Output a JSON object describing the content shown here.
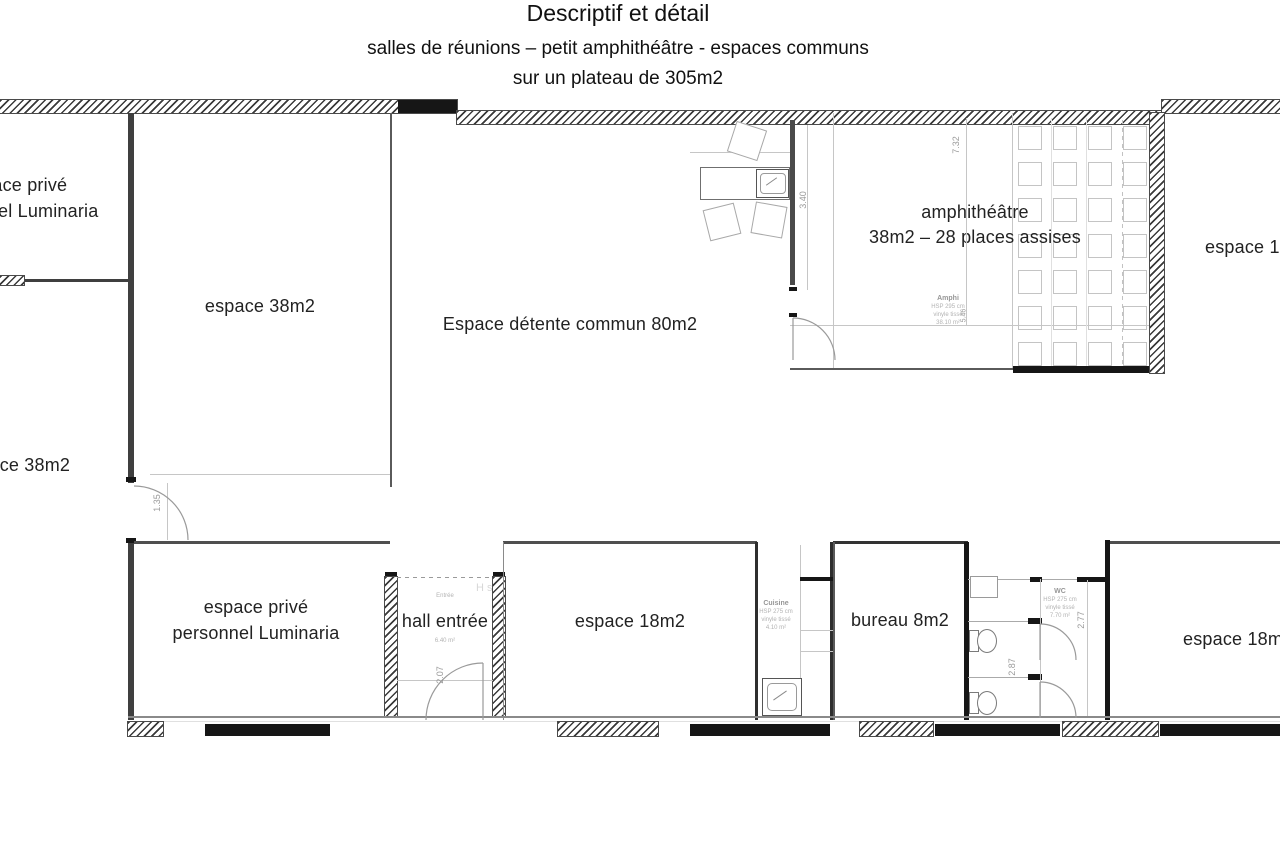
{
  "title": {
    "line1": "Descriptif et détail",
    "line2": "salles de réunions – petit amphithéâtre - espaces communs",
    "line3": "sur un plateau de 305m2"
  },
  "labels": {
    "top_left_1": "espace privé",
    "top_left_2": "personnel Luminaria",
    "espace38_top": "espace 38m2",
    "espace38_left": "espace 38m2",
    "detente": "Espace détente commun 80m2",
    "amphi_1": "amphithéâtre",
    "amphi_2": "38m2 – 28 places assises",
    "espace18_top_right": "espace 18m2",
    "private_bottom_1": "espace privé",
    "private_bottom_2": "personnel Luminaria",
    "hall": "hall entrée",
    "espace18_center": "espace 18m2",
    "bureau": "bureau 8m2",
    "espace18_bottom_right": "espace 18m2"
  },
  "annotations": {
    "amphi": {
      "name": "Amphi",
      "hsp": "HSP 295 cm",
      "finish": "vinyle tissé",
      "area": "38.10 m²"
    },
    "cuisine": {
      "name": "Cuisine",
      "hsp": "HSP 275 cm",
      "finish": "vinyle tissé",
      "area": "4.10 m²"
    },
    "wc": {
      "name": "WC",
      "hsp": "HSP 275 cm",
      "finish": "vinyle tissé",
      "area": "7.70 m²"
    },
    "hall_sub": "Entrée",
    "hall_area": "6.40 m²",
    "hall_tag": "H s"
  },
  "dimensions": {
    "d732": "7.32",
    "d340": "3.40",
    "d546": "5.46",
    "d207": "2.07",
    "d135": "1.35",
    "d277": "2.77",
    "d287": "2.87"
  },
  "amphi_seats": {
    "rows": 7,
    "cols": 4
  },
  "colors": {
    "wall_dark": "#161616",
    "wall_mid": "#3f3f3f",
    "hatch": "#3a3a3a",
    "muted_text": "#9a9a9a",
    "seat_line": "#c4c4c4"
  }
}
